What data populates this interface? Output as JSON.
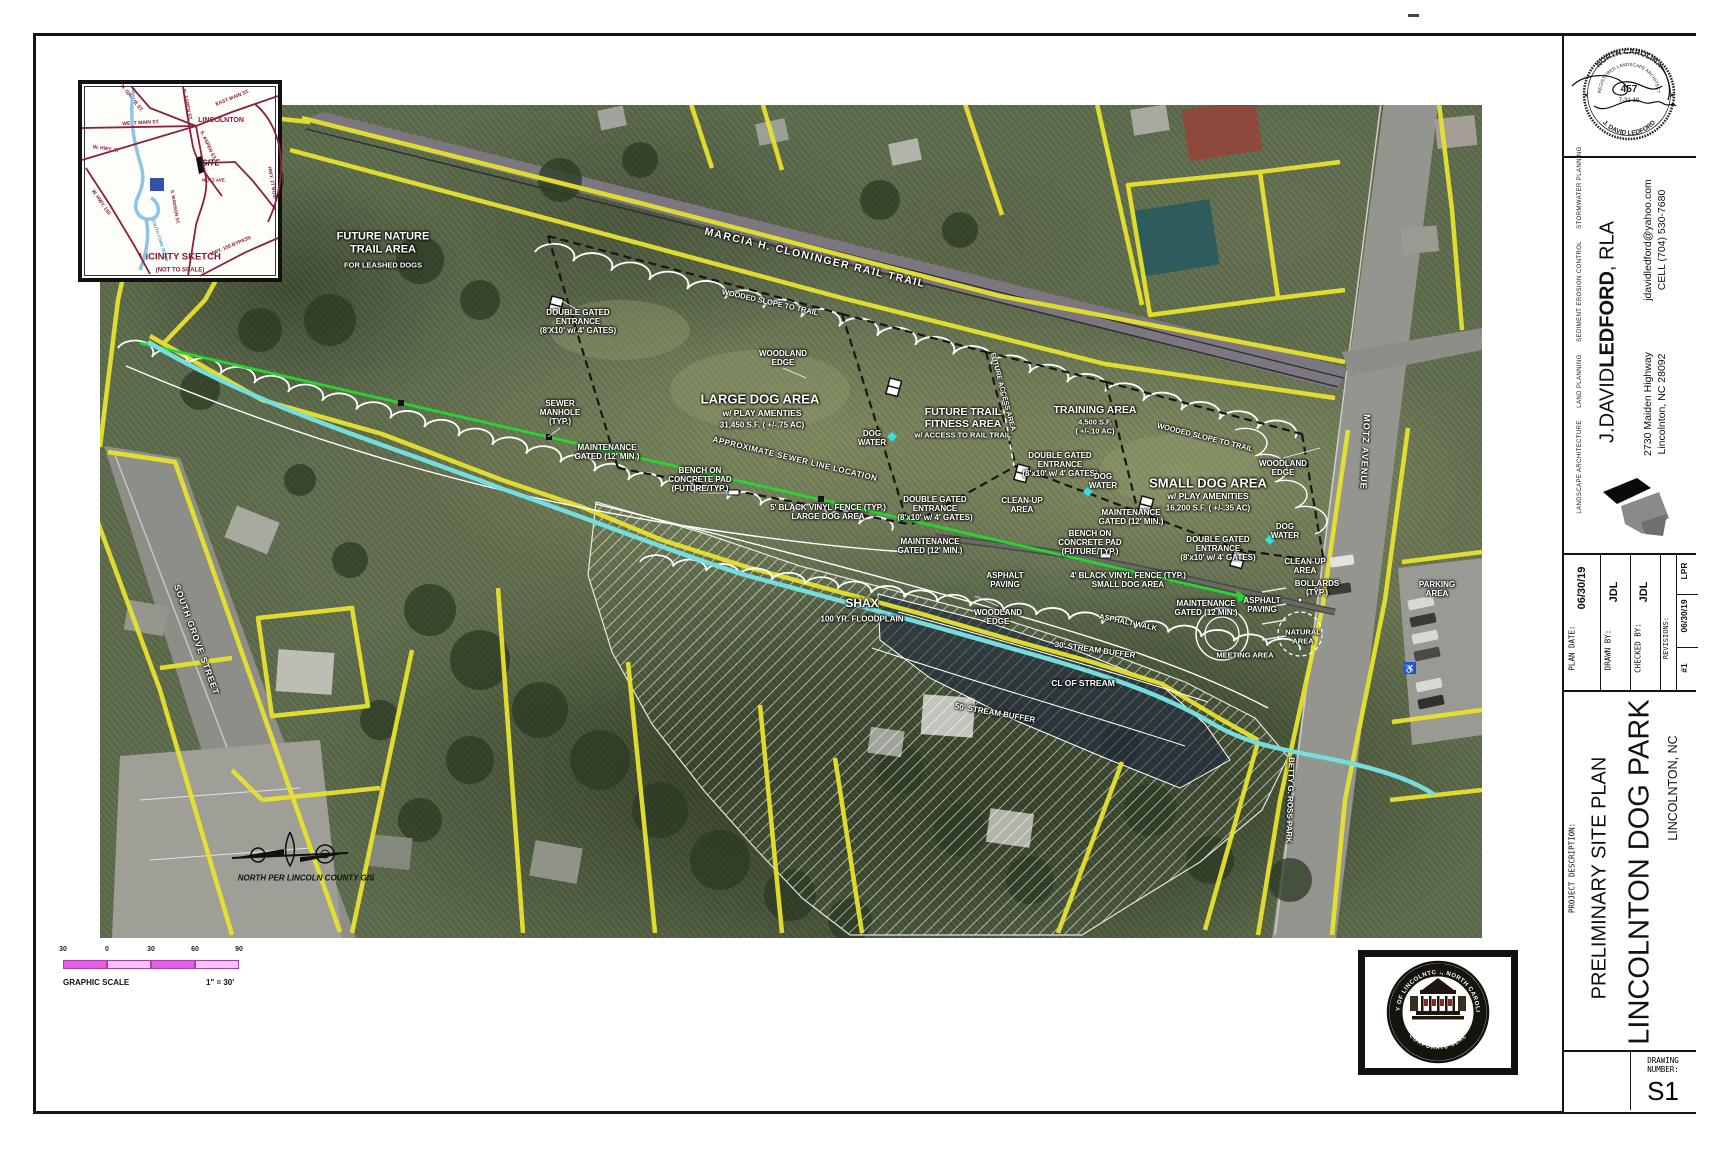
{
  "vicinity": {
    "labels": [
      {
        "t": "LINCOLNTON",
        "x": 221,
        "y": 121,
        "s": 7
      },
      {
        "t": "WEST MAIN ST.",
        "x": 141,
        "y": 124,
        "s": 5,
        "r": -3
      },
      {
        "t": "EAST MAIN ST.",
        "x": 233,
        "y": 99,
        "s": 5,
        "r": -22
      },
      {
        "t": "N. GROVE ST.",
        "x": 131,
        "y": 99,
        "s": 5,
        "r": 52
      },
      {
        "t": "N. ASPEN ST.",
        "x": 186,
        "y": 105,
        "s": 5,
        "r": 78
      },
      {
        "t": "S. ASPEN ST.",
        "x": 207,
        "y": 146,
        "s": 5,
        "r": 65
      },
      {
        "t": "SITE",
        "x": 211,
        "y": 163,
        "s": 8,
        "c": "#111",
        "it": true
      },
      {
        "t": "MOTZ AVE.",
        "x": 214,
        "y": 180,
        "s": 4.5
      },
      {
        "t": "S. MADISON ST.",
        "x": 175,
        "y": 207,
        "s": 4.5,
        "r": 80
      },
      {
        "t": "W. HWY. 27",
        "x": 106,
        "y": 150,
        "s": 5,
        "r": 8
      },
      {
        "t": "W. HWY. 150",
        "x": 100,
        "y": 203,
        "s": 5,
        "r": 55
      },
      {
        "t": "HWY. 150 BYPASS",
        "x": 231,
        "y": 247,
        "s": 5,
        "r": -23
      },
      {
        "t": "HWY. 27 BUS.",
        "x": 271,
        "y": 183,
        "s": 5,
        "r": 80
      },
      {
        "t": "SOUTH FORK RIVER",
        "x": 160,
        "y": 240,
        "s": 4.5,
        "r": 72,
        "c": "#4a9ac8",
        "it": true
      },
      {
        "t": "CITY\nPARK",
        "x": 157,
        "y": 185,
        "s": 4.2,
        "c": "#ffffff"
      },
      {
        "t": "VICINITY SKETCH",
        "x": 180,
        "y": 258,
        "s": 9.5
      },
      {
        "t": "(NOT TO SCALE)",
        "x": 180,
        "y": 271,
        "s": 6
      }
    ]
  },
  "plan_labels": [
    {
      "t": "FUTURE NATURE\nTRAIL AREA",
      "x": 383,
      "y": 243,
      "s": 11
    },
    {
      "t": "FOR LEASHED DOGS",
      "x": 383,
      "y": 266,
      "s": 7.5
    },
    {
      "t": "MARCIA H. CLONINGER RAIL TRAIL",
      "x": 815,
      "y": 258,
      "r": 13.5,
      "s": 10.5,
      "ls": 1.5
    },
    {
      "t": "WOODED SLOPE TO TRAIL",
      "x": 770,
      "y": 303,
      "r": 12.5,
      "s": 7.5
    },
    {
      "t": "WOODED SLOPE TO TRAIL",
      "x": 1205,
      "y": 438,
      "r": 14,
      "s": 7.5
    },
    {
      "t": "DOUBLE GATED\nENTRANCE\n(8'X10' w/ 4' GATES)",
      "x": 578,
      "y": 322,
      "s": 8
    },
    {
      "t": "WOODLAND\nEDGE",
      "x": 783,
      "y": 358,
      "s": 8
    },
    {
      "t": "LARGE DOG AREA",
      "x": 760,
      "y": 400,
      "s": 13
    },
    {
      "t": "w/ PLAY AMENTIES",
      "x": 762,
      "y": 414,
      "s": 8.5
    },
    {
      "t": "31,450 S.F.  ( +/-.75 AC)",
      "x": 762,
      "y": 425,
      "s": 8
    },
    {
      "t": "SEWER\nMANHOLE\n(TYP.)",
      "x": 560,
      "y": 413,
      "s": 8
    },
    {
      "t": "MAINTENANCE\nGATED (12' MIN.)",
      "x": 607,
      "y": 452,
      "s": 8
    },
    {
      "t": "BENCH ON\nCONCRETE PAD\n(FUTURE/TYP.)",
      "x": 700,
      "y": 480,
      "s": 8
    },
    {
      "t": "DOG\nWATER",
      "x": 872,
      "y": 438,
      "s": 8
    },
    {
      "t": "FUTURE TRAIL\nFITNESS AREA",
      "x": 963,
      "y": 418,
      "s": 10.5
    },
    {
      "t": "w/ ACCESS TO RAIL TRAIL",
      "x": 963,
      "y": 436,
      "s": 7.5
    },
    {
      "t": "FUTURE ACCESS AREA",
      "x": 1002,
      "y": 392,
      "r": 75,
      "s": 7
    },
    {
      "t": "TRAINING AREA",
      "x": 1095,
      "y": 410,
      "s": 10.5
    },
    {
      "t": "4,500 S.F.\n( +/-.10 AC)",
      "x": 1095,
      "y": 427,
      "s": 7.5
    },
    {
      "t": "DOUBLE GATED\nENTRANCE\n(8'x10' w/ 4' GATES)",
      "x": 1060,
      "y": 465,
      "s": 8
    },
    {
      "t": "DOG\nWATER",
      "x": 1103,
      "y": 481,
      "s": 8
    },
    {
      "t": "SMALL DOG AREA",
      "x": 1208,
      "y": 484,
      "s": 13
    },
    {
      "t": "w/ PLAY AMENITIES",
      "x": 1208,
      "y": 497,
      "s": 8.5
    },
    {
      "t": "16,200 S.F.  ( +/-.35 AC)",
      "x": 1208,
      "y": 508,
      "s": 8
    },
    {
      "t": "WOODLAND\nEDGE",
      "x": 1283,
      "y": 468,
      "s": 8
    },
    {
      "t": "MAINTENANCE\nGATED (12' MIN.)",
      "x": 1131,
      "y": 517,
      "s": 8
    },
    {
      "t": "BENCH ON\nCONCRETE PAD\n(FUTURE/TYP.)",
      "x": 1090,
      "y": 543,
      "s": 8
    },
    {
      "t": "CLEAN-UP\nAREA",
      "x": 1022,
      "y": 505,
      "s": 8
    },
    {
      "t": "5' BLACK VINYL FENCE (TYP.)\nLARGE DOG AREA",
      "x": 828,
      "y": 512,
      "s": 8
    },
    {
      "t": "APPROXIMATE SEWER LINE LOCATION",
      "x": 795,
      "y": 459,
      "r": 13.5,
      "s": 8,
      "ls": 0.5
    },
    {
      "t": "DOUBLE GATED\nENTRANCE\n(8'x10' w/ 4' GATES)",
      "x": 935,
      "y": 509,
      "s": 8
    },
    {
      "t": "MAINTENANCE\nGATED (12' MIN.)",
      "x": 930,
      "y": 546,
      "s": 8
    },
    {
      "t": "DOUBLE GATED\nENTRANCE\n(8'x10' w/ 4' GATES)",
      "x": 1218,
      "y": 549,
      "s": 8
    },
    {
      "t": "MAINTENANCE\nGATED (12 MIN.)",
      "x": 1206,
      "y": 608,
      "s": 8
    },
    {
      "t": "DOG\nWATER",
      "x": 1285,
      "y": 531,
      "s": 8
    },
    {
      "t": "CLEAN-UP\nAREA",
      "x": 1305,
      "y": 566,
      "s": 8
    },
    {
      "t": "BOLLARDS\n(TYP.)",
      "x": 1317,
      "y": 588,
      "s": 8
    },
    {
      "t": "ASPHALT\nPAVING",
      "x": 1005,
      "y": 580,
      "s": 8
    },
    {
      "t": "ASPHALT\nPAVING",
      "x": 1262,
      "y": 605,
      "s": 8
    },
    {
      "t": "WOODLAND\nEDGE",
      "x": 998,
      "y": 617,
      "s": 8
    },
    {
      "t": "4' BLACK VINYL FENCE (TYP.)\nSMALL DOG AREA",
      "x": 1128,
      "y": 580,
      "s": 8
    },
    {
      "t": "ASPHALT WALK",
      "x": 1128,
      "y": 623,
      "r": 12,
      "s": 7.5
    },
    {
      "t": "SHAX",
      "x": 862,
      "y": 604,
      "s": 12
    },
    {
      "t": "100 YR. FLOODPLAIN",
      "x": 862,
      "y": 619,
      "s": 8
    },
    {
      "t": "30' STREAM BUFFER",
      "x": 1095,
      "y": 650,
      "r": 8,
      "s": 8
    },
    {
      "t": "CL OF STREAM",
      "x": 1083,
      "y": 684,
      "s": 8.5
    },
    {
      "t": "50' STREAM BUFFER",
      "x": 995,
      "y": 713,
      "r": 10,
      "s": 8
    },
    {
      "t": "MEETING AREA",
      "x": 1245,
      "y": 656,
      "s": 7.5
    },
    {
      "t": "NATURAL\nAREA",
      "x": 1303,
      "y": 637,
      "s": 7.5
    },
    {
      "t": "PARKING\nAREA",
      "x": 1437,
      "y": 589,
      "s": 8
    },
    {
      "t": "MOTZ AVENUE",
      "x": 1365,
      "y": 452,
      "r": 93,
      "s": 9,
      "ls": 1
    },
    {
      "t": "SOUTH GROVE STREET",
      "x": 196,
      "y": 640,
      "r": 70,
      "s": 8.5,
      "ls": 1
    },
    {
      "t": "BETTY G. ROSS PARK",
      "x": 1290,
      "y": 800,
      "r": 92,
      "s": 8
    },
    {
      "t": "NORTH PER LINCOLN COUNTY GIS",
      "x": 306,
      "y": 878,
      "s": 8,
      "c": "#111",
      "it": true
    }
  ],
  "scale": {
    "ticks": [
      "30",
      "0",
      "30",
      "60",
      "90"
    ],
    "caption": "GRAPHIC SCALE",
    "ratio": "1\" = 30'"
  },
  "stamp": {
    "state": "NORTH CAROLINA",
    "title": "REGISTERED LANDSCAPE ARCHITECT",
    "number": "457",
    "expires": "7-31-19",
    "name": "J. DAVID LEDFORD",
    "star": "★"
  },
  "city_seal": {
    "ring_text": "CITY OF LINCOLNTON, NORTH CAROLINA",
    "bottom_text": "CORPORATE SEAL"
  },
  "titleblock": {
    "firm_first": "J.DAVID",
    "firm_last": "LEDFORD",
    "firm_suffix": ", RLA",
    "services": "LANDSCAPE ARCHITECTURE      LAND PLANNING      SEDIMENT EROSION CONTROL      STORMWATER PLANNING",
    "email": "jdavidledford@yahoo.com",
    "cell": "CELL (704) 530-7680",
    "address1": "2730 Maiden Highway",
    "address2": "Lincolnton, NC 28092",
    "plan_date_label": "PLAN DATE:",
    "plan_date": "06/30/19",
    "drawn_by_label": "DRAWN BY:",
    "drawn_by": "JDL",
    "checked_by_label": "CHECKED BY:",
    "checked_by": "JDL",
    "revisions_label": "REVISIONS:",
    "revision_num": "#1",
    "revision_date": "06/30/19",
    "revision_by": "LPR",
    "project_description_label": "PROJECT DESCRIPTION:",
    "project_title1": "PRELIMINARY SITE PLAN",
    "project_title2": "LINCOLNTON DOG PARK",
    "project_location": "LINCOLNTON, NC",
    "drawing_number_label": "DRAWING\nNUMBER:",
    "drawing_number": "S1"
  }
}
